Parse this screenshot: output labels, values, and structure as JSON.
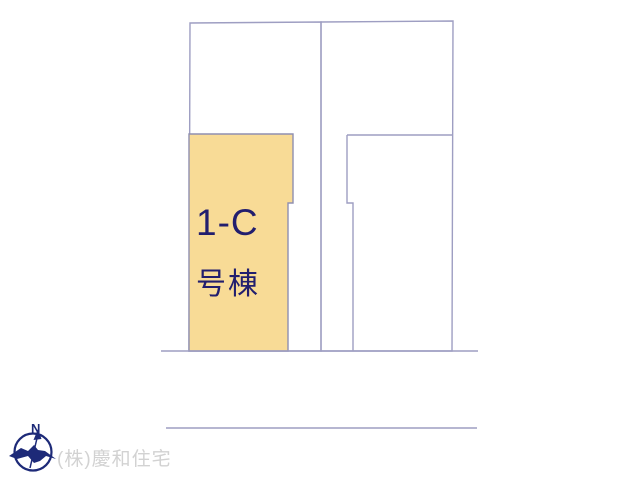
{
  "canvas": {
    "width": 640,
    "height": 480,
    "background": "#ffffff"
  },
  "plan": {
    "line_color": "#9e9ec2",
    "parcel_border_color": "#8f8fb0",
    "highlight": {
      "fill": "#f8db96",
      "label_line1": "1-C",
      "label_line2": "号棟",
      "label_color": "#221e6e"
    },
    "shapes": {
      "left-parcel-outline": {
        "type": "polygon",
        "points": "190,23 321,22 321,351 189,351",
        "fill": "none"
      },
      "right-parcel-outline": {
        "type": "polygon",
        "points": "321,22 453,21 452,351 321,351",
        "fill": "none"
      },
      "right-inner-top-line": {
        "type": "polyline",
        "points": "347,135 452,135",
        "fill": "none"
      },
      "right-inner-side-line": {
        "type": "polyline",
        "points": "347,135 347,203 353,203 353,351",
        "fill": "none"
      },
      "lot-1c-highlight": {
        "type": "polygon",
        "points": "189,134 293,134 293,203 288,203 288,351 189,351",
        "fill": "highlight"
      },
      "front-boundary-line": {
        "type": "polyline",
        "points": "161,351 478,351",
        "fill": "none"
      },
      "road-line": {
        "type": "polyline",
        "points": "166,428 477,428",
        "fill": "none"
      }
    }
  },
  "compass": {
    "north_label": "N",
    "color": "#1d2a78"
  },
  "footer": {
    "company": "(株)慶和住宅",
    "color": "#d2d2d2"
  }
}
